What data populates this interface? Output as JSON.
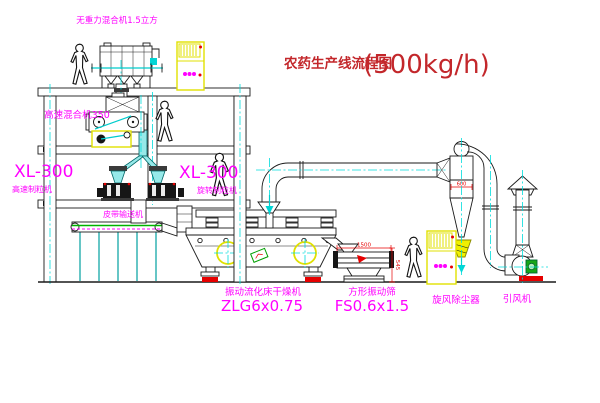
{
  "title": {
    "main": "农药生产线流程图",
    "capacity": "(500kg/h)"
  },
  "labels": {
    "gravity_mixer": "无重力混合机1.5立方",
    "high_speed_mixer": "高速混合机350",
    "granulator_left": {
      "model": "XL-300",
      "name": "高速制粒机"
    },
    "granulator_right": {
      "model": "XL-300",
      "name": "旋转制粒机"
    },
    "belt_conveyor": "皮带输送机",
    "dryer": {
      "name": "振动流化床干燥机",
      "model": "ZLG6x0.75"
    },
    "sieve": {
      "name": "方形振动筛",
      "model": "FS0.6x1.5"
    },
    "cyclone": "旋风除尘器",
    "fan": "引风机"
  },
  "dimensions": {
    "sieve_length": "1500",
    "sieve_side": "545",
    "cyclone_body": "600"
  },
  "colors": {
    "label": "#ff00ff",
    "title": "#c3272b",
    "dimension": "#e60000",
    "centerline": "#00dcdc",
    "highlight": "#e8e800"
  }
}
